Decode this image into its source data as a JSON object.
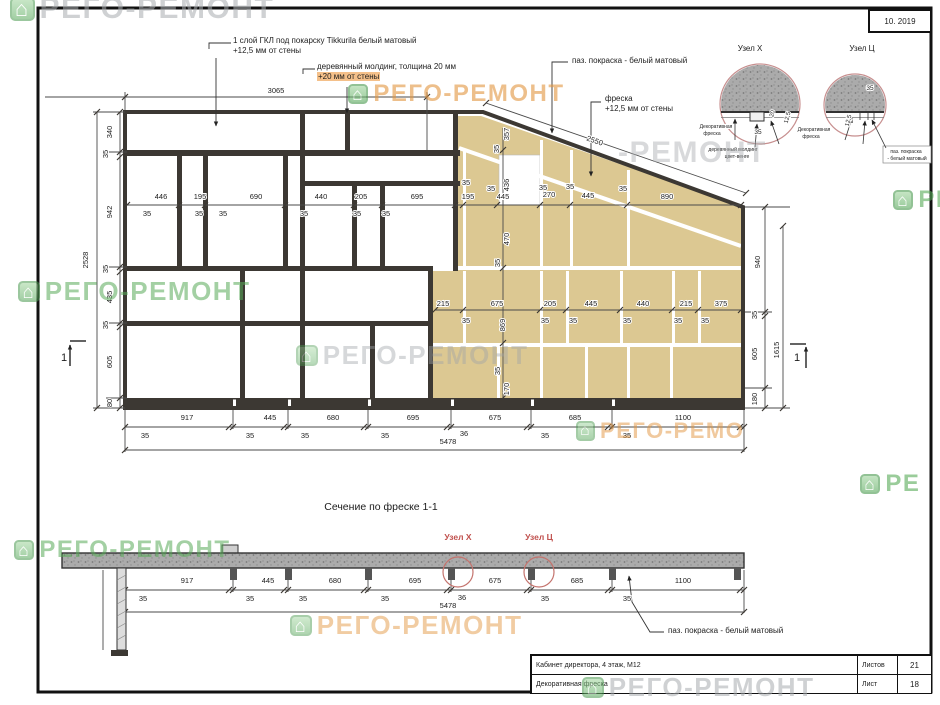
{
  "frame": {
    "date": "10. 2019"
  },
  "callouts": {
    "gkl_line1": "1 слой ГКЛ  под покарску Tikkurila белый матовый",
    "gkl_line2": "+12,5 мм от стены",
    "molding_line1": "деревянный молдинг, толщина 20 мм",
    "molding_line2": "+20 мм от стены",
    "groove_paint": "паз. покраска - белый матовый",
    "fresco_line1": "фреска",
    "fresco_line2": "+12,5 мм от стены",
    "section_groove_paint": "паз. покраска - белый матовый"
  },
  "title_block": {
    "row1": "Кабинет директора, 4 этаж,  М12",
    "row2": "Декоративная фреска",
    "sheets_label": "Листов",
    "sheets_value": "21",
    "sheet_label": "Лист",
    "sheet_value": "18"
  },
  "watermark_text": "РЕГО-РЕМОНТ",
  "watermark_glyph": "⌂",
  "colors": {
    "beige": "#dcc892",
    "line": "#3c3833",
    "red": "#c0504d",
    "green": "#58ab58",
    "orange": "#e2953f",
    "gray": "#a9adb0"
  },
  "watermarks": [
    {
      "x": 10,
      "y": -8,
      "s": 30,
      "c": "#a9adb0",
      "o": 0.55,
      "icon": true
    },
    {
      "x": 348,
      "y": 80,
      "s": 24,
      "c": "#e2953f",
      "o": 0.6,
      "icon": true
    },
    {
      "x": 618,
      "y": 136,
      "s": 30,
      "c": "#a9adb0",
      "o": 0.45,
      "icon": false,
      "t": "-РЕМОНТ"
    },
    {
      "x": 18,
      "y": 276,
      "s": 26,
      "c": "#58ab58",
      "o": 0.55,
      "icon": true
    },
    {
      "x": 296,
      "y": 340,
      "s": 26,
      "c": "#9fa4a8",
      "o": 0.42,
      "icon": true
    },
    {
      "x": 893,
      "y": 186,
      "s": 24,
      "c": "#58ab58",
      "o": 0.6,
      "icon": true,
      "t": "РЕ"
    },
    {
      "x": 860,
      "y": 470,
      "s": 24,
      "c": "#58ab58",
      "o": 0.6,
      "icon": true,
      "t": "РЕ"
    },
    {
      "x": 14,
      "y": 536,
      "s": 24,
      "c": "#58ab58",
      "o": 0.55,
      "icon": true
    },
    {
      "x": 576,
      "y": 418,
      "s": 22,
      "c": "#e2953f",
      "o": 0.5,
      "icon": true,
      "t": "РЕГО-РЕМО"
    },
    {
      "x": 290,
      "y": 610,
      "s": 26,
      "c": "#e2953f",
      "o": 0.48,
      "icon": true
    },
    {
      "x": 582,
      "y": 672,
      "s": 26,
      "c": "#a9adb0",
      "o": 0.55,
      "icon": true
    }
  ],
  "labels": [
    {
      "t": "3065",
      "x": 276,
      "y": 93
    },
    {
      "t": "2550",
      "x": 594,
      "y": 143,
      "r": 19
    },
    {
      "t": "340",
      "x": 112,
      "y": 132,
      "r": -90
    },
    {
      "t": "35",
      "x": 108,
      "y": 154,
      "r": -90
    },
    {
      "t": "942",
      "x": 112,
      "y": 212,
      "r": -90
    },
    {
      "t": "35",
      "x": 108,
      "y": 269,
      "r": -90
    },
    {
      "t": "435",
      "x": 112,
      "y": 297,
      "r": -90
    },
    {
      "t": "35",
      "x": 108,
      "y": 325,
      "r": -90
    },
    {
      "t": "605",
      "x": 112,
      "y": 362,
      "r": -90
    },
    {
      "t": "80",
      "x": 112,
      "y": 403,
      "r": -90
    },
    {
      "t": "2528",
      "x": 88,
      "y": 260,
      "r": -90
    },
    {
      "t": "446",
      "x": 161,
      "y": 199
    },
    {
      "t": "195",
      "x": 200,
      "y": 199
    },
    {
      "t": "690",
      "x": 256,
      "y": 199
    },
    {
      "t": "440",
      "x": 321,
      "y": 199
    },
    {
      "t": "205",
      "x": 361,
      "y": 199
    },
    {
      "t": "695",
      "x": 417,
      "y": 199
    },
    {
      "t": "195",
      "x": 468,
      "y": 199
    },
    {
      "t": "445",
      "x": 503,
      "y": 199
    },
    {
      "t": "270",
      "x": 549,
      "y": 197
    },
    {
      "t": "445",
      "x": 588,
      "y": 198
    },
    {
      "t": "890",
      "x": 667,
      "y": 199
    },
    {
      "t": "35",
      "x": 147,
      "y": 216
    },
    {
      "t": "35",
      "x": 199,
      "y": 216
    },
    {
      "t": "35",
      "x": 223,
      "y": 216
    },
    {
      "t": "35",
      "x": 304,
      "y": 216
    },
    {
      "t": "35",
      "x": 357,
      "y": 216
    },
    {
      "t": "35",
      "x": 386,
      "y": 216
    },
    {
      "t": "35",
      "x": 466,
      "y": 185
    },
    {
      "t": "35",
      "x": 491,
      "y": 191
    },
    {
      "t": "35",
      "x": 543,
      "y": 190
    },
    {
      "t": "35",
      "x": 570,
      "y": 189
    },
    {
      "t": "35",
      "x": 623,
      "y": 191
    },
    {
      "t": "357",
      "x": 509,
      "y": 134,
      "r": -90
    },
    {
      "t": "35",
      "x": 499,
      "y": 149,
      "r": -90
    },
    {
      "t": "436",
      "x": 509,
      "y": 185,
      "r": -90
    },
    {
      "t": "470",
      "x": 509,
      "y": 239,
      "r": -90
    },
    {
      "t": "35",
      "x": 500,
      "y": 263,
      "r": -90
    },
    {
      "t": "869",
      "x": 505,
      "y": 325,
      "r": -90
    },
    {
      "t": "35",
      "x": 500,
      "y": 371,
      "r": -90
    },
    {
      "t": "170",
      "x": 509,
      "y": 389,
      "r": -90
    },
    {
      "t": "215",
      "x": 443,
      "y": 306
    },
    {
      "t": "675",
      "x": 497,
      "y": 306
    },
    {
      "t": "205",
      "x": 550,
      "y": 306
    },
    {
      "t": "445",
      "x": 591,
      "y": 306
    },
    {
      "t": "440",
      "x": 643,
      "y": 306
    },
    {
      "t": "215",
      "x": 686,
      "y": 306
    },
    {
      "t": "375",
      "x": 721,
      "y": 306
    },
    {
      "t": "35",
      "x": 466,
      "y": 323
    },
    {
      "t": "35",
      "x": 545,
      "y": 323
    },
    {
      "t": "35",
      "x": 573,
      "y": 323
    },
    {
      "t": "35",
      "x": 627,
      "y": 323
    },
    {
      "t": "35",
      "x": 678,
      "y": 323
    },
    {
      "t": "35",
      "x": 705,
      "y": 323
    },
    {
      "t": "940",
      "x": 760,
      "y": 262,
      "r": -90
    },
    {
      "t": "35",
      "x": 757,
      "y": 315,
      "r": -90
    },
    {
      "t": "605",
      "x": 757,
      "y": 354,
      "r": -90
    },
    {
      "t": "180",
      "x": 757,
      "y": 399,
      "r": -90
    },
    {
      "t": "1615",
      "x": 779,
      "y": 350,
      "r": -90
    },
    {
      "t": "917",
      "x": 187,
      "y": 420
    },
    {
      "t": "445",
      "x": 270,
      "y": 420
    },
    {
      "t": "680",
      "x": 333,
      "y": 420
    },
    {
      "t": "695",
      "x": 413,
      "y": 420
    },
    {
      "t": "675",
      "x": 495,
      "y": 420
    },
    {
      "t": "685",
      "x": 575,
      "y": 420
    },
    {
      "t": "1100",
      "x": 683,
      "y": 420
    },
    {
      "t": "35",
      "x": 145,
      "y": 438
    },
    {
      "t": "35",
      "x": 250,
      "y": 438
    },
    {
      "t": "35",
      "x": 305,
      "y": 438
    },
    {
      "t": "35",
      "x": 385,
      "y": 438
    },
    {
      "t": "36",
      "x": 464,
      "y": 436
    },
    {
      "t": "35",
      "x": 545,
      "y": 438
    },
    {
      "t": "35",
      "x": 627,
      "y": 438
    },
    {
      "t": "5478",
      "x": 448,
      "y": 444
    },
    {
      "t": "917",
      "x": 187,
      "y": 583
    },
    {
      "t": "445",
      "x": 268,
      "y": 583
    },
    {
      "t": "680",
      "x": 335,
      "y": 583
    },
    {
      "t": "695",
      "x": 415,
      "y": 583
    },
    {
      "t": "675",
      "x": 495,
      "y": 583
    },
    {
      "t": "685",
      "x": 577,
      "y": 583
    },
    {
      "t": "1100",
      "x": 683,
      "y": 583
    },
    {
      "t": "35",
      "x": 143,
      "y": 601
    },
    {
      "t": "35",
      "x": 250,
      "y": 601
    },
    {
      "t": "35",
      "x": 303,
      "y": 601
    },
    {
      "t": "35",
      "x": 385,
      "y": 601
    },
    {
      "t": "36",
      "x": 462,
      "y": 600
    },
    {
      "t": "35",
      "x": 545,
      "y": 601
    },
    {
      "t": "35",
      "x": 627,
      "y": 601
    },
    {
      "t": "5478",
      "x": 448,
      "y": 608
    },
    {
      "t": "Узел Х",
      "x": 750,
      "y": 51,
      "s": 8
    },
    {
      "t": "Узел Ц",
      "x": 862,
      "y": 51,
      "s": 8
    },
    {
      "t": "20",
      "x": 774,
      "y": 114,
      "r": -75,
      "s": 6
    },
    {
      "t": "12,5",
      "x": 789,
      "y": 118,
      "r": -75,
      "s": 6
    },
    {
      "t": "35",
      "x": 758,
      "y": 134,
      "s": 6.5
    },
    {
      "t": "Декоративная",
      "x": 716,
      "y": 128,
      "s": 5
    },
    {
      "t": "фреска",
      "x": 712,
      "y": 135,
      "s": 5
    },
    {
      "t": "деревянный молдинг",
      "x": 733,
      "y": 151,
      "s": 5
    },
    {
      "t": "цвет-венге",
      "x": 737,
      "y": 158,
      "s": 5
    },
    {
      "t": "35",
      "x": 870,
      "y": 90,
      "s": 6.5
    },
    {
      "t": "12,5",
      "x": 850,
      "y": 121,
      "r": -75,
      "s": 6
    },
    {
      "t": "Декоративная",
      "x": 814,
      "y": 131,
      "s": 5
    },
    {
      "t": "фреска",
      "x": 811,
      "y": 138,
      "s": 5
    },
    {
      "t": "паз. покраска",
      "x": 906,
      "y": 153,
      "s": 5
    },
    {
      "t": "- белый матовый",
      "x": 907,
      "y": 160,
      "s": 5
    },
    {
      "t": "Сечение по фреске 1-1",
      "x": 381,
      "y": 510,
      "s": 10.5
    },
    {
      "t": "Узел Х",
      "x": 458,
      "y": 540,
      "s": 8.5,
      "c": "#c0504d",
      "b": 1
    },
    {
      "t": "Узел Ц",
      "x": 539,
      "y": 540,
      "s": 8.5,
      "c": "#c0504d",
      "b": 1
    },
    {
      "t": "1",
      "x": 64,
      "y": 361,
      "s": 11
    },
    {
      "t": "1",
      "x": 797,
      "y": 361,
      "s": 11
    }
  ]
}
